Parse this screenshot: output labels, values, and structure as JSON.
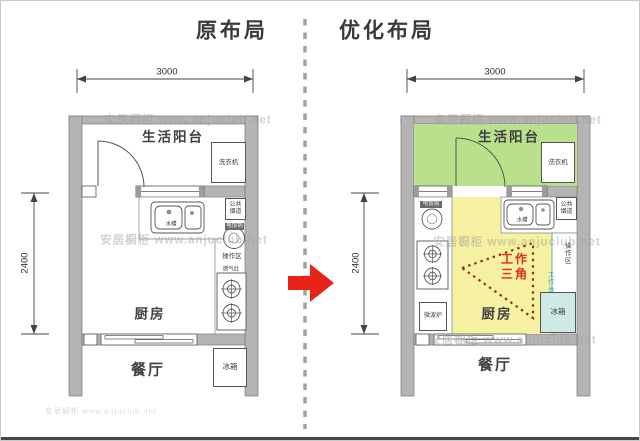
{
  "watermark": {
    "text": "安居橱柜 www.anjuclub.net",
    "footer": "安居橱柜 www.anjuclub.net"
  },
  "plans": {
    "original": {
      "title": "原布局",
      "width_dim": "3000",
      "height_dim": "2400",
      "labels": {
        "balcony": "生活阳台",
        "washer": "洗衣机",
        "sink": "水槽",
        "flue_1": "公共",
        "flue_2": "烟道",
        "cooker": "电饭锅",
        "op_zone": "操作区",
        "stove": "燃气灶",
        "kitchen": "厨房",
        "dining": "餐厅",
        "fridge": "冰箱"
      }
    },
    "optimized": {
      "title": "优化布局",
      "width_dim": "3000",
      "height_dim": "2400",
      "labels": {
        "balcony": "生活阳台",
        "washer": "洗衣机",
        "sink": "水槽",
        "flue_1": "公共",
        "flue_2": "烟道",
        "cooker": "电饭锅",
        "op_zone": "操作区",
        "work_line": "工作台",
        "microwave": "微波炉",
        "triangle_1": "工作",
        "triangle_2": "三角",
        "kitchen": "厨房",
        "dining": "餐厅",
        "fridge": "冰箱"
      }
    }
  },
  "colors": {
    "balcony_green": "#b9e08d",
    "kitchen_yellow": "#f5f1a0",
    "fridge_cyan": "#cdeae6",
    "wall_gray": "#b4b4b4",
    "triangle_stroke": "#8a3a12",
    "triangle_text_red": "#e02a1e",
    "arrow_red": "#e8231a",
    "work_line_cyan": "#2fb5b5"
  }
}
